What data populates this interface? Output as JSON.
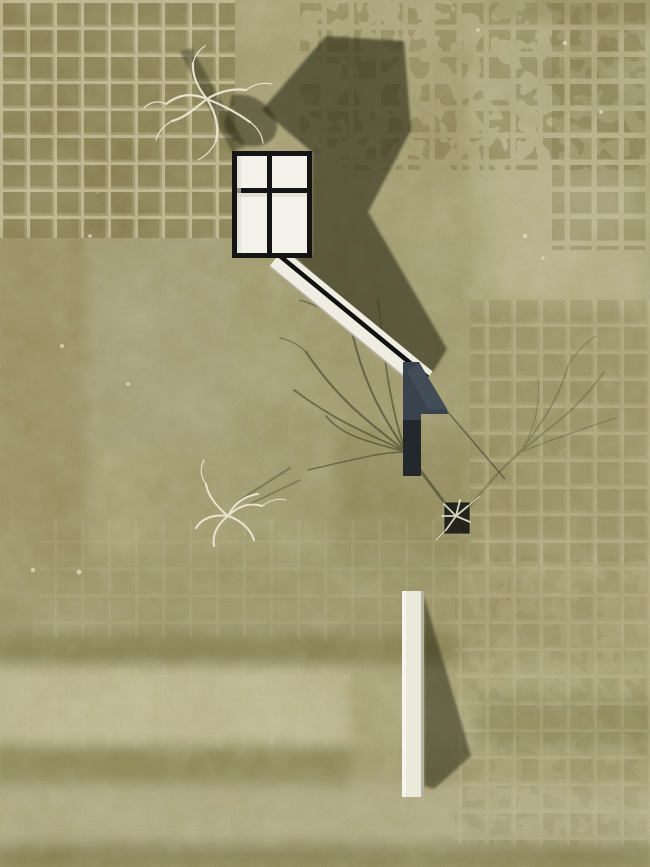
{
  "image": {
    "kind": "top-down aerial architectural site render",
    "width_px": 650,
    "height_px": 867,
    "text_visible": "none"
  },
  "scene": {
    "objects": [
      {
        "name": "skylight-building",
        "description": "white flat roof split into four panels by a dark cross of mullions, heavy dark frame, upper-left of center"
      },
      {
        "name": "building-shadow",
        "description": "large dark cast shadow extending up-right and down-right of the roof toward the sunken stair"
      },
      {
        "name": "entry-ramp",
        "description": "long white diagonal ramp with a dark central slot running from the roof corner down-right to a sunken stair"
      },
      {
        "name": "sunken-stair-pit",
        "description": "dark slate-blue angular pit / stair void where the ramp terminates"
      },
      {
        "name": "freestanding-wall",
        "description": "vertical white wall strip in the lower center casting a long shadow to its right"
      },
      {
        "name": "tree-top-left",
        "description": "bare white-branched tree seen from above with dark shadow blob"
      },
      {
        "name": "tree-mid-left",
        "description": "small bare white tree seen from above on open lawn"
      },
      {
        "name": "tree-in-pit",
        "description": "small tree growing out of a tiny dark square opening in the lawn"
      },
      {
        "name": "tree-shadow-fan-center",
        "description": "branching shadow fanning up-left from the square opening"
      },
      {
        "name": "tree-shadow-fan-right",
        "description": "fainter branch shadow fanning up-right"
      },
      {
        "name": "paver-grids",
        "description": "mossy square paver fields, partially overgrown, in top-left, top-right, mid-right and bottom-right areas"
      },
      {
        "name": "lawn-bands",
        "description": "horizontal mowing/tonal bands across lower third of lawn"
      },
      {
        "name": "stone-specks",
        "description": "scattered tiny pale stones"
      }
    ],
    "colors": {
      "terrain_base": "#a49c6e",
      "terrain_light": "#c2bb93",
      "terrain_dark": "#7c7543",
      "paver_dark": "#7c7444",
      "paver_joint": "#c6bf97",
      "shadow_color": "#2a2c18",
      "branch_shadow": "#43452b",
      "building_frame": "#141414",
      "building_panel": "#f3f1e9",
      "ramp_surface": "#efede1",
      "ramp_slot": "#111111",
      "pit_color": "#39434e",
      "pit_dark": "#191c20",
      "wall_color": "#ebe8dc",
      "wall_edge": "#b4b0a0",
      "tree_white": "#ece7d4",
      "stone_speck": "#d9d4b9",
      "pit_square": "#23251c"
    }
  }
}
